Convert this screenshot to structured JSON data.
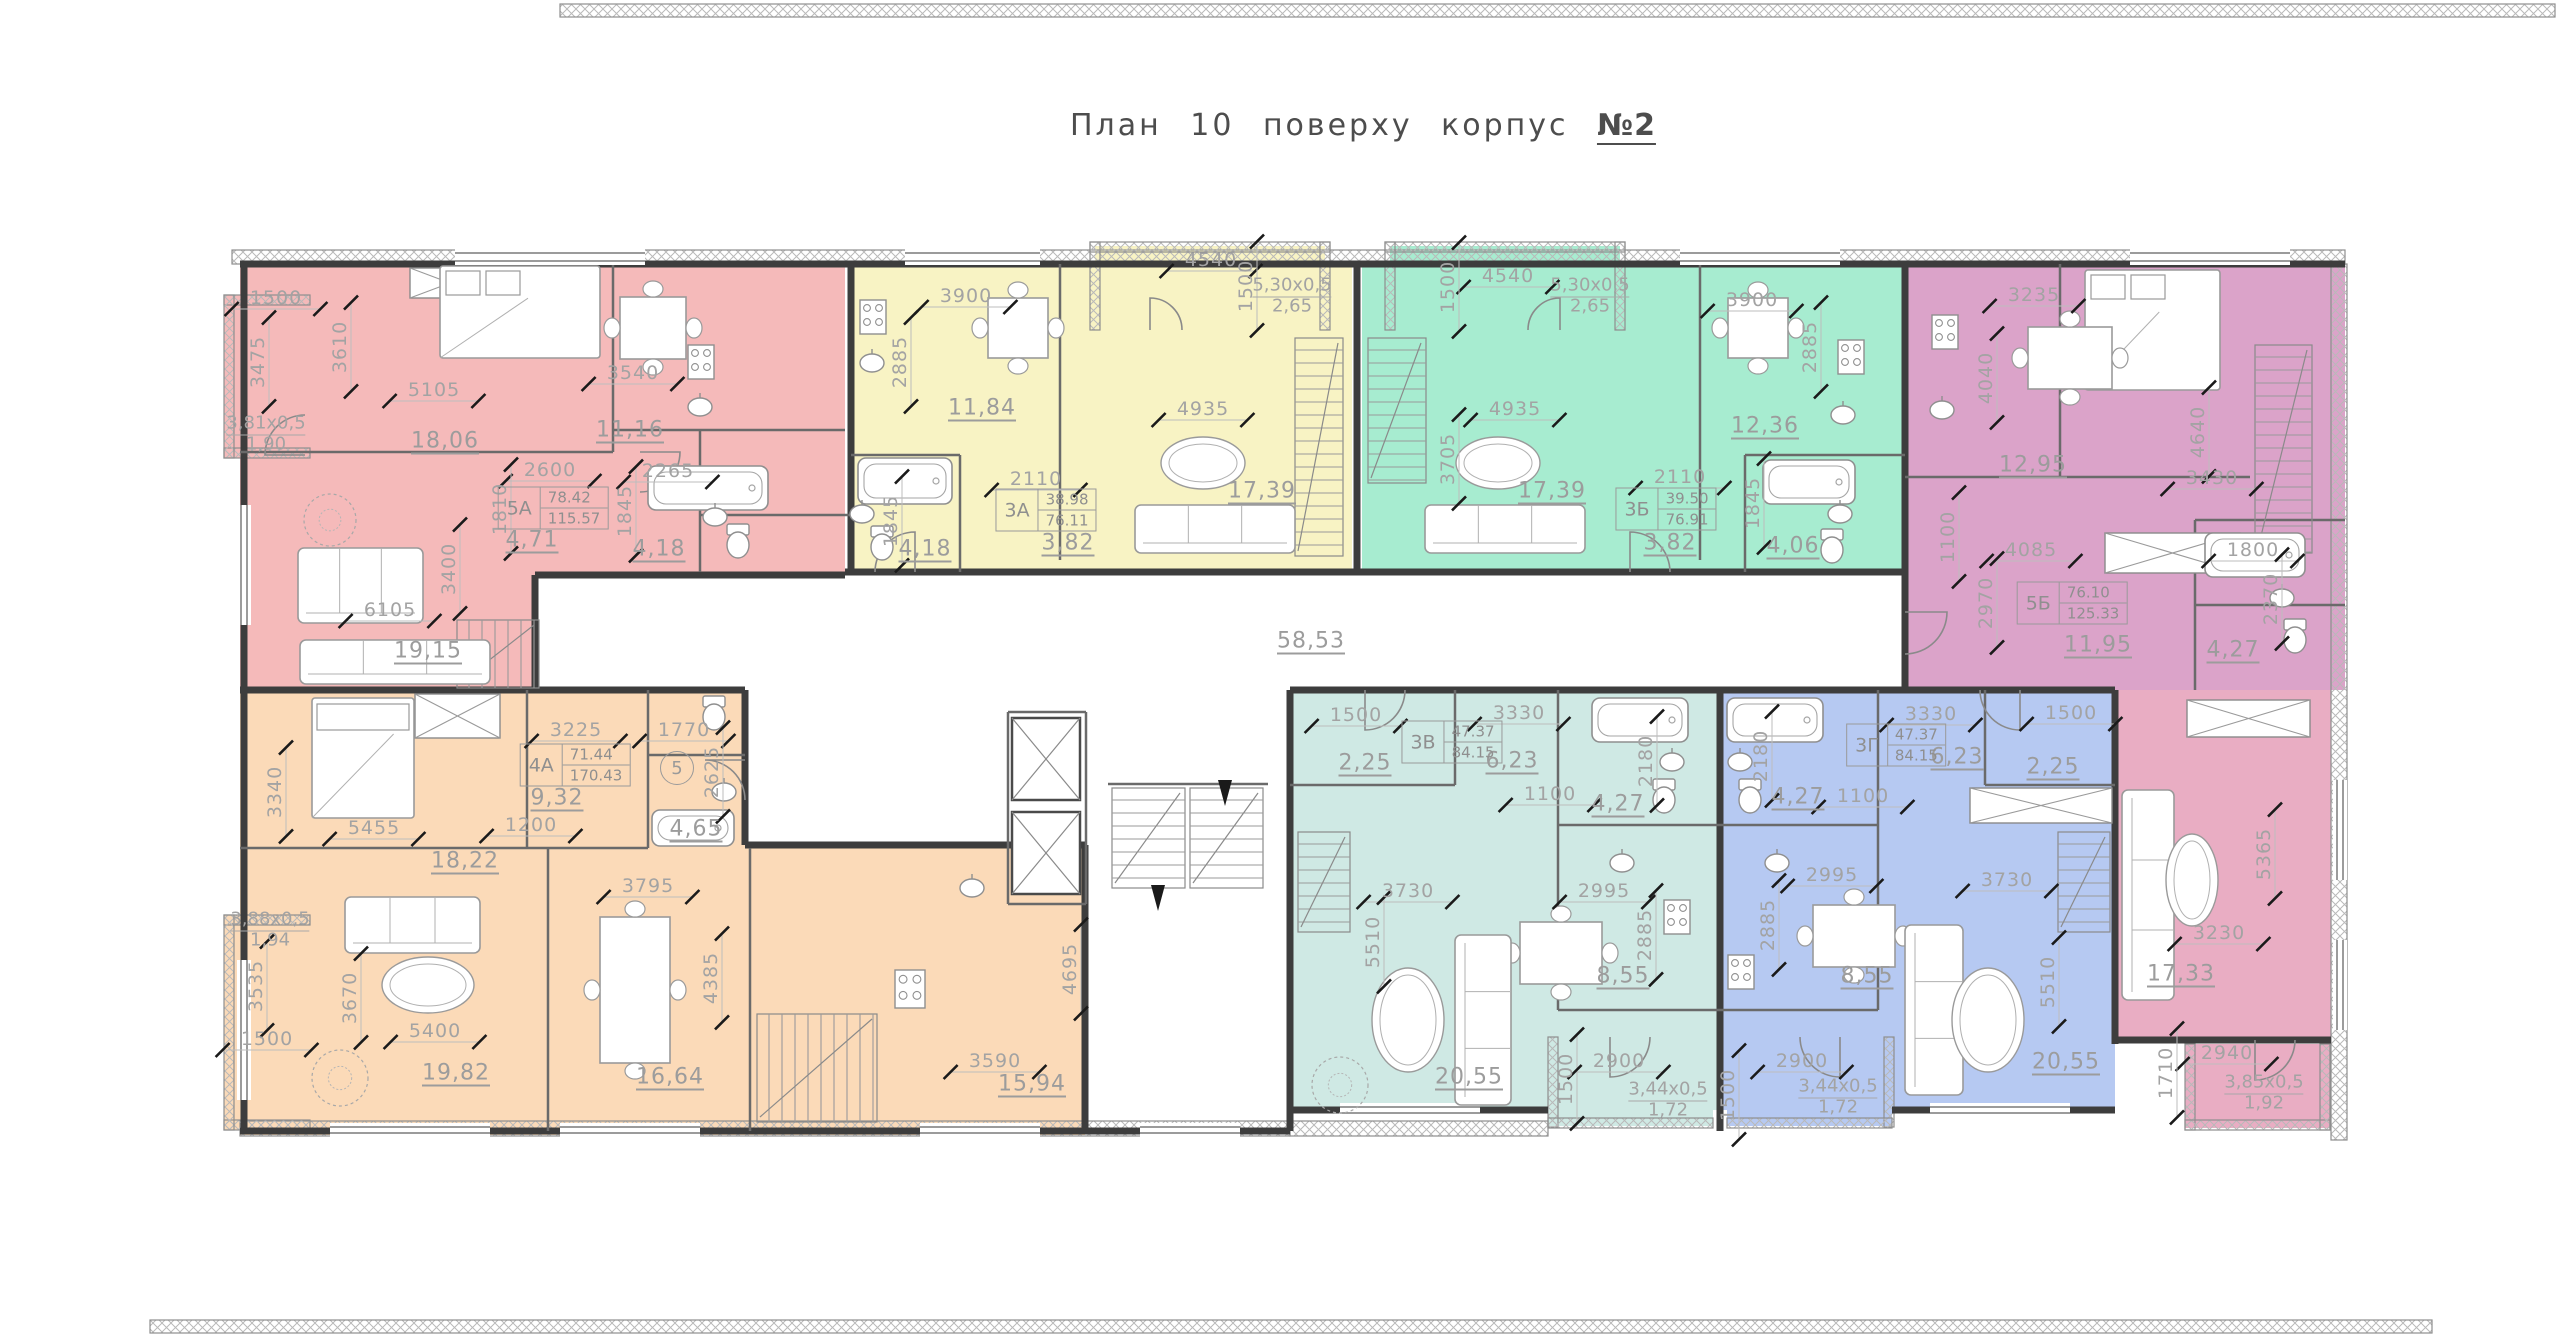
{
  "title_prefix": "План 10 поверху корпус",
  "title_number": "№2",
  "corridor_area": "58,53",
  "axis_marker": {
    "t": "5",
    "x": 677,
    "y": 768
  },
  "apartments": [
    {
      "code": "5А",
      "living": "78.42",
      "total": "115.57",
      "color": "#f5baba",
      "label": {
        "x": 553,
        "y": 508
      }
    },
    {
      "code": "3А",
      "living": "38.98",
      "total": "76.11",
      "color": "#f8f3c4",
      "label": {
        "x": 1046,
        "y": 510
      }
    },
    {
      "code": "3Б",
      "living": "39.50",
      "total": "76.91",
      "color": "#a7ecd0",
      "label": {
        "x": 1666,
        "y": 509
      }
    },
    {
      "code": "5Б",
      "living": "76.10",
      "total": "125.33",
      "color": "#dba3c9",
      "lower_color": "#e9adc3",
      "label": {
        "x": 2072,
        "y": 603
      }
    },
    {
      "code": "4А",
      "living": "71.44",
      "total": "170.43",
      "color": "#fbdab8",
      "label": {
        "x": 575,
        "y": 765
      }
    },
    {
      "code": "3В",
      "living": "47.37",
      "total": "84.15",
      "color": "#cfe9e4",
      "label": {
        "x": 1452,
        "y": 742
      }
    },
    {
      "code": "3Г",
      "living": "47.37",
      "total": "84.15",
      "color": "#b6c9f2",
      "label": {
        "x": 1896,
        "y": 745
      }
    }
  ],
  "labels": [
    {
      "t": "1500",
      "x": 276,
      "y": 298,
      "k": "dim"
    },
    {
      "t": "3475",
      "x": 258,
      "y": 362,
      "r": 1,
      "k": "dim"
    },
    {
      "t": "3610",
      "x": 340,
      "y": 347,
      "r": 1,
      "k": "dim"
    },
    {
      "t": "5105",
      "x": 434,
      "y": 390,
      "k": "dim"
    },
    {
      "t": "18,06",
      "x": 445,
      "y": 441,
      "k": "area"
    },
    {
      "t": "3,81х0,5",
      "x": 266,
      "y": 424,
      "k": "ftop"
    },
    {
      "t": "1,90",
      "x": 266,
      "y": 444,
      "k": "fbot"
    },
    {
      "t": "2600",
      "x": 550,
      "y": 470,
      "k": "dim"
    },
    {
      "t": "1810",
      "x": 500,
      "y": 509,
      "r": 1,
      "k": "dim"
    },
    {
      "t": "4,71",
      "x": 532,
      "y": 540,
      "k": "area"
    },
    {
      "t": "11,16",
      "x": 630,
      "y": 430,
      "k": "area"
    },
    {
      "t": "3540",
      "x": 633,
      "y": 373,
      "k": "dim"
    },
    {
      "t": "2265",
      "x": 668,
      "y": 471,
      "k": "dim"
    },
    {
      "t": "1845",
      "x": 625,
      "y": 511,
      "r": 1,
      "k": "dim"
    },
    {
      "t": "4,18",
      "x": 659,
      "y": 549,
      "k": "area"
    },
    {
      "t": "3400",
      "x": 449,
      "y": 569,
      "r": 1,
      "k": "dim"
    },
    {
      "t": "6105",
      "x": 390,
      "y": 610,
      "k": "dim"
    },
    {
      "t": "19,15",
      "x": 428,
      "y": 651,
      "k": "area"
    },
    {
      "t": "3900",
      "x": 966,
      "y": 296,
      "k": "dim"
    },
    {
      "t": "2885",
      "x": 900,
      "y": 362,
      "r": 1,
      "k": "dim"
    },
    {
      "t": "11,84",
      "x": 982,
      "y": 408,
      "k": "area"
    },
    {
      "t": "4540",
      "x": 1211,
      "y": 260,
      "k": "dim"
    },
    {
      "t": "1500",
      "x": 1246,
      "y": 286,
      "r": 1,
      "k": "dim"
    },
    {
      "t": "5,30х0,5",
      "x": 1292,
      "y": 286,
      "k": "ftop"
    },
    {
      "t": "2,65",
      "x": 1292,
      "y": 306,
      "k": "fbot"
    },
    {
      "t": "4935",
      "x": 1203,
      "y": 409,
      "k": "dim"
    },
    {
      "t": "17,39",
      "x": 1262,
      "y": 491,
      "k": "area"
    },
    {
      "t": "2110",
      "x": 1036,
      "y": 479,
      "k": "dim"
    },
    {
      "t": "3,82",
      "x": 1068,
      "y": 543,
      "k": "area"
    },
    {
      "t": "4,18",
      "x": 925,
      "y": 549,
      "k": "area"
    },
    {
      "t": "1845",
      "x": 891,
      "y": 521,
      "r": 1,
      "k": "dim"
    },
    {
      "t": "4540",
      "x": 1508,
      "y": 276,
      "k": "dim"
    },
    {
      "t": "1500",
      "x": 1448,
      "y": 287,
      "r": 1,
      "k": "dim"
    },
    {
      "t": "5,30х0,5",
      "x": 1590,
      "y": 286,
      "k": "ftop"
    },
    {
      "t": "2,65",
      "x": 1590,
      "y": 306,
      "k": "fbot"
    },
    {
      "t": "3900",
      "x": 1752,
      "y": 300,
      "k": "dim"
    },
    {
      "t": "2885",
      "x": 1810,
      "y": 347,
      "r": 1,
      "k": "dim"
    },
    {
      "t": "4935",
      "x": 1515,
      "y": 409,
      "k": "dim"
    },
    {
      "t": "3705",
      "x": 1448,
      "y": 459,
      "r": 1,
      "k": "dim"
    },
    {
      "t": "17,39",
      "x": 1552,
      "y": 491,
      "k": "area"
    },
    {
      "t": "12,36",
      "x": 1765,
      "y": 426,
      "k": "area"
    },
    {
      "t": "2110",
      "x": 1680,
      "y": 477,
      "k": "dim"
    },
    {
      "t": "3,82",
      "x": 1670,
      "y": 543,
      "k": "area"
    },
    {
      "t": "1845",
      "x": 1753,
      "y": 503,
      "r": 1,
      "k": "dim"
    },
    {
      "t": "4,06",
      "x": 1793,
      "y": 546,
      "k": "area"
    },
    {
      "t": "3235",
      "x": 2034,
      "y": 295,
      "k": "dim"
    },
    {
      "t": "4040",
      "x": 1986,
      "y": 378,
      "r": 1,
      "k": "dim"
    },
    {
      "t": "12,95",
      "x": 2033,
      "y": 465,
      "k": "area"
    },
    {
      "t": "4640",
      "x": 2198,
      "y": 432,
      "r": 1,
      "k": "dim"
    },
    {
      "t": "3430",
      "x": 2212,
      "y": 478,
      "k": "dim"
    },
    {
      "t": "1100",
      "x": 1948,
      "y": 537,
      "r": 1,
      "k": "dim"
    },
    {
      "t": "4085",
      "x": 2031,
      "y": 550,
      "k": "dim"
    },
    {
      "t": "2970",
      "x": 1986,
      "y": 603,
      "r": 1,
      "k": "dim"
    },
    {
      "t": "11,95",
      "x": 2098,
      "y": 645,
      "k": "area"
    },
    {
      "t": "1800",
      "x": 2253,
      "y": 550,
      "k": "dim"
    },
    {
      "t": "2370",
      "x": 2271,
      "y": 599,
      "r": 1,
      "k": "dim"
    },
    {
      "t": "4,27",
      "x": 2233,
      "y": 650,
      "k": "area"
    },
    {
      "t": "5365",
      "x": 2264,
      "y": 854,
      "r": 1,
      "k": "dim"
    },
    {
      "t": "3230",
      "x": 2219,
      "y": 933,
      "k": "dim"
    },
    {
      "t": "17,33",
      "x": 2181,
      "y": 974,
      "k": "area"
    },
    {
      "t": "2940",
      "x": 2227,
      "y": 1053,
      "k": "dim"
    },
    {
      "t": "1710",
      "x": 2166,
      "y": 1073,
      "r": 1,
      "k": "dim"
    },
    {
      "t": "3,85х0,5",
      "x": 2264,
      "y": 1083,
      "k": "ftop"
    },
    {
      "t": "1,92",
      "x": 2264,
      "y": 1103,
      "k": "fbot"
    },
    {
      "t": "3340",
      "x": 275,
      "y": 792,
      "r": 1,
      "k": "dim"
    },
    {
      "t": "5455",
      "x": 374,
      "y": 828,
      "k": "dim"
    },
    {
      "t": "18,22",
      "x": 465,
      "y": 861,
      "k": "area"
    },
    {
      "t": "3225",
      "x": 576,
      "y": 730,
      "k": "dim"
    },
    {
      "t": "9,32",
      "x": 557,
      "y": 798,
      "k": "area"
    },
    {
      "t": "1200",
      "x": 531,
      "y": 825,
      "k": "dim"
    },
    {
      "t": "1770",
      "x": 684,
      "y": 730,
      "k": "dim"
    },
    {
      "t": "2625",
      "x": 712,
      "y": 772,
      "r": 1,
      "k": "dim"
    },
    {
      "t": "4,65",
      "x": 696,
      "y": 829,
      "k": "area"
    },
    {
      "t": "3795",
      "x": 648,
      "y": 886,
      "k": "dim"
    },
    {
      "t": "3,88х0,5",
      "x": 270,
      "y": 920,
      "k": "ftop"
    },
    {
      "t": "1,94",
      "x": 270,
      "y": 940,
      "k": "fbot"
    },
    {
      "t": "3535",
      "x": 256,
      "y": 986,
      "r": 1,
      "k": "dim"
    },
    {
      "t": "1500",
      "x": 267,
      "y": 1039,
      "k": "dim"
    },
    {
      "t": "3670",
      "x": 350,
      "y": 998,
      "r": 1,
      "k": "dim"
    },
    {
      "t": "5400",
      "x": 435,
      "y": 1031,
      "k": "dim"
    },
    {
      "t": "19,82",
      "x": 456,
      "y": 1073,
      "k": "area"
    },
    {
      "t": "16,64",
      "x": 670,
      "y": 1077,
      "k": "area"
    },
    {
      "t": "4385",
      "x": 711,
      "y": 978,
      "r": 1,
      "k": "dim"
    },
    {
      "t": "4695",
      "x": 1070,
      "y": 969,
      "r": 1,
      "k": "dim"
    },
    {
      "t": "3590",
      "x": 995,
      "y": 1061,
      "k": "dim"
    },
    {
      "t": "15,94",
      "x": 1032,
      "y": 1084,
      "k": "area"
    },
    {
      "t": "58,53",
      "x": 1311,
      "y": 641,
      "k": "area"
    },
    {
      "t": "1500",
      "x": 1356,
      "y": 715,
      "k": "dim"
    },
    {
      "t": "3330",
      "x": 1519,
      "y": 713,
      "k": "dim"
    },
    {
      "t": "2,25",
      "x": 1365,
      "y": 763,
      "k": "area"
    },
    {
      "t": "6,23",
      "x": 1512,
      "y": 761,
      "k": "area"
    },
    {
      "t": "1100",
      "x": 1550,
      "y": 794,
      "k": "dim"
    },
    {
      "t": "4,27",
      "x": 1618,
      "y": 804,
      "k": "area"
    },
    {
      "t": "2180",
      "x": 1646,
      "y": 761,
      "r": 1,
      "k": "dim"
    },
    {
      "t": "3730",
      "x": 1408,
      "y": 891,
      "k": "dim"
    },
    {
      "t": "5510",
      "x": 1373,
      "y": 942,
      "r": 1,
      "k": "dim"
    },
    {
      "t": "2995",
      "x": 1604,
      "y": 891,
      "k": "dim"
    },
    {
      "t": "2885",
      "x": 1645,
      "y": 935,
      "r": 1,
      "k": "dim"
    },
    {
      "t": "8,55",
      "x": 1623,
      "y": 976,
      "k": "area"
    },
    {
      "t": "20,55",
      "x": 1469,
      "y": 1077,
      "k": "area"
    },
    {
      "t": "1500",
      "x": 1566,
      "y": 1079,
      "r": 1,
      "k": "dim"
    },
    {
      "t": "2900",
      "x": 1619,
      "y": 1061,
      "k": "dim"
    },
    {
      "t": "3,44х0,5",
      "x": 1668,
      "y": 1090,
      "k": "ftop"
    },
    {
      "t": "1,72",
      "x": 1668,
      "y": 1110,
      "k": "fbot"
    },
    {
      "t": "3330",
      "x": 1931,
      "y": 714,
      "k": "dim"
    },
    {
      "t": "1500",
      "x": 2071,
      "y": 713,
      "k": "dim"
    },
    {
      "t": "6,23",
      "x": 1957,
      "y": 757,
      "k": "area"
    },
    {
      "t": "2,25",
      "x": 2053,
      "y": 767,
      "k": "area"
    },
    {
      "t": "4,27",
      "x": 1798,
      "y": 797,
      "k": "area"
    },
    {
      "t": "1100",
      "x": 1863,
      "y": 796,
      "k": "dim"
    },
    {
      "t": "2180",
      "x": 1761,
      "y": 756,
      "r": 1,
      "k": "dim"
    },
    {
      "t": "2995",
      "x": 1832,
      "y": 875,
      "k": "dim"
    },
    {
      "t": "2885",
      "x": 1768,
      "y": 925,
      "r": 1,
      "k": "dim"
    },
    {
      "t": "8,55",
      "x": 1867,
      "y": 976,
      "k": "area"
    },
    {
      "t": "3730",
      "x": 2007,
      "y": 880,
      "k": "dim"
    },
    {
      "t": "5510",
      "x": 2048,
      "y": 982,
      "r": 1,
      "k": "dim"
    },
    {
      "t": "20,55",
      "x": 2066,
      "y": 1062,
      "k": "area"
    },
    {
      "t": "2900",
      "x": 1802,
      "y": 1061,
      "k": "dim"
    },
    {
      "t": "1500",
      "x": 1728,
      "y": 1095,
      "r": 1,
      "k": "dim"
    },
    {
      "t": "3,44х0,5",
      "x": 1838,
      "y": 1087,
      "k": "ftop"
    },
    {
      "t": "1,72",
      "x": 1838,
      "y": 1107,
      "k": "fbot"
    }
  ]
}
